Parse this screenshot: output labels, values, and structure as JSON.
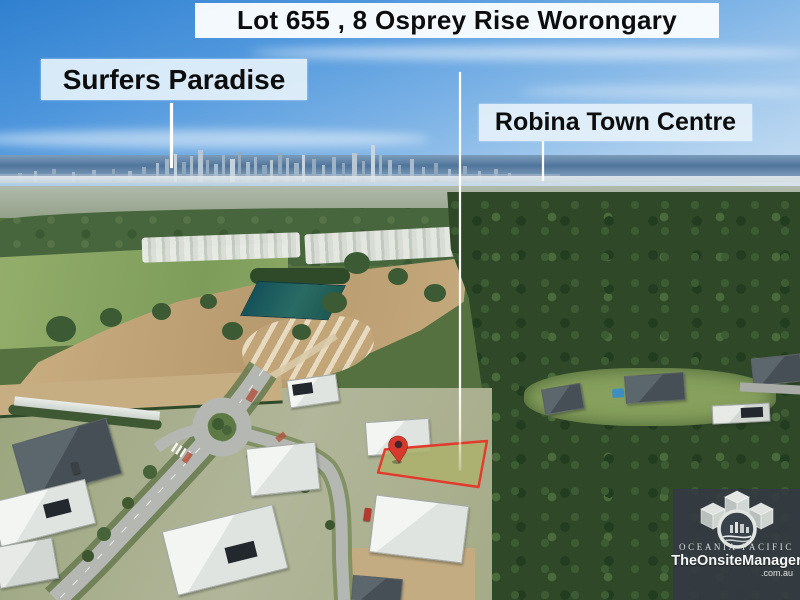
{
  "banner": {
    "title": "Lot 655 , 8 Osprey Rise Worongary"
  },
  "labels": {
    "surfers_paradise": "Surfers Paradise",
    "robina_town_centre": "Robina Town Centre"
  },
  "watermark": {
    "brand_top": "OCEANIA PACIFIC",
    "brand_main": "TheOnsiteManager",
    "brand_suffix": ".com.au",
    "logo_icon": "oceania-pacific-cubes-logo"
  },
  "marker": {
    "icon": "map-pin-icon"
  },
  "colors": {
    "lot_outline_red": "#e23a2c",
    "lot_fill_tint": "rgba(235,70,45,0.05)",
    "pin_red": "#d6392e",
    "pin_dot": "#43262a",
    "pointer_line": "#ffffff",
    "banner_bg": "#f9fcfe",
    "label_bg": "#e5f1fa",
    "watermark_bg": "#343b42",
    "sky_top_blue": "#2f80d0",
    "forest_green": "#2e4828"
  }
}
